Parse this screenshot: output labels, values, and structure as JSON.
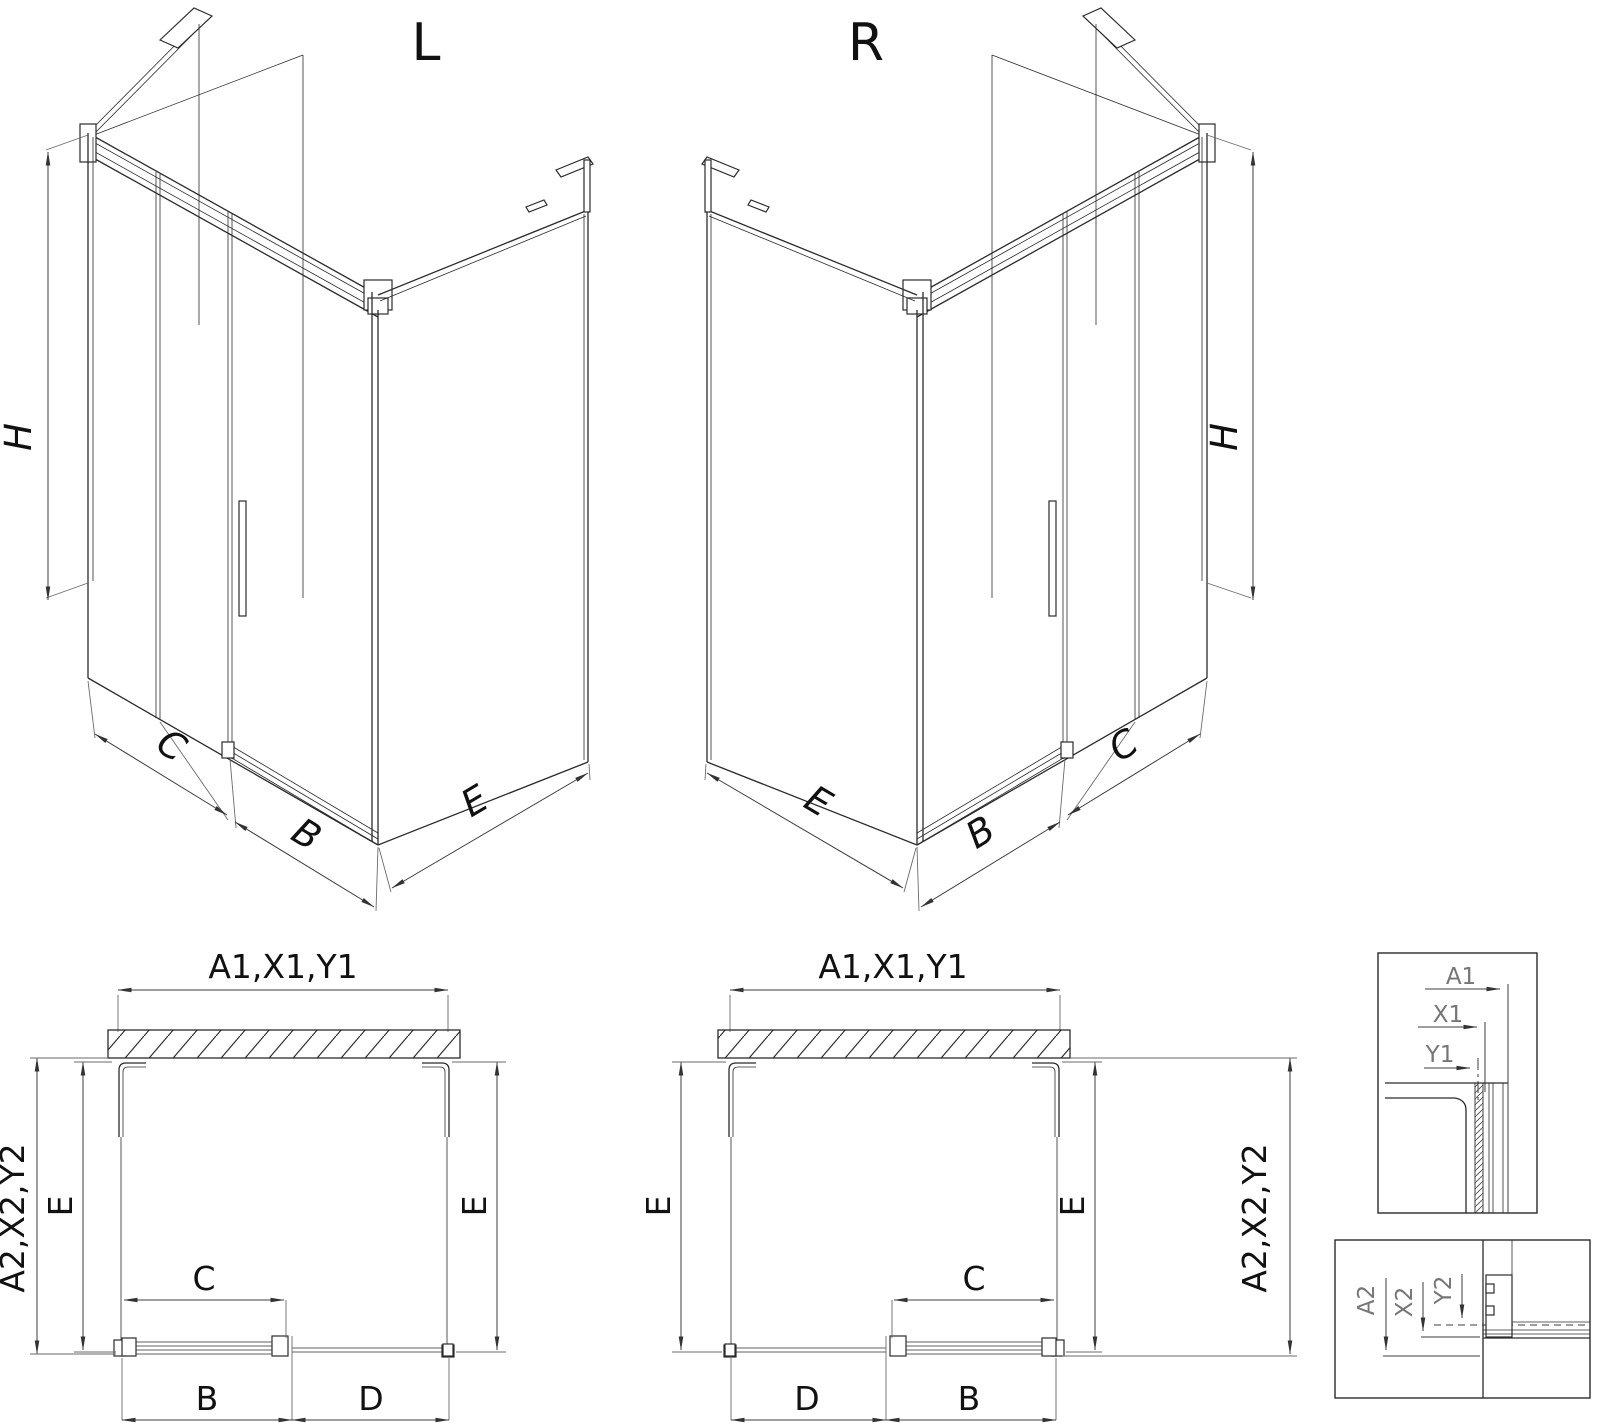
{
  "drawing": {
    "iso_left": {
      "title": "L",
      "dim_height": "H",
      "dim_panel_c": "C",
      "dim_door_b": "B",
      "dim_side_e": "E"
    },
    "iso_right": {
      "title": "R",
      "dim_height": "H",
      "dim_panel_c": "C",
      "dim_door_b": "B",
      "dim_side_e": "E"
    },
    "plan_left": {
      "dim_width_top": "A1,X1,Y1",
      "dim_depth_outer": "A2,X2,Y2",
      "dim_depth_left": "E",
      "dim_depth_right": "E",
      "dim_door_panel": "C",
      "dim_bottom_left": "B",
      "dim_bottom_right": "D"
    },
    "plan_right": {
      "dim_width_top": "A1,X1,Y1",
      "dim_depth_outer": "A2,X2,Y2",
      "dim_depth_left": "E",
      "dim_depth_right": "E",
      "dim_door_panel": "C",
      "dim_bottom_left": "D",
      "dim_bottom_right": "B"
    },
    "detail_top": {
      "labels": [
        "A1",
        "X1",
        "Y1"
      ]
    },
    "detail_bottom": {
      "labels": [
        "A2",
        "X2",
        "Y2"
      ]
    }
  }
}
